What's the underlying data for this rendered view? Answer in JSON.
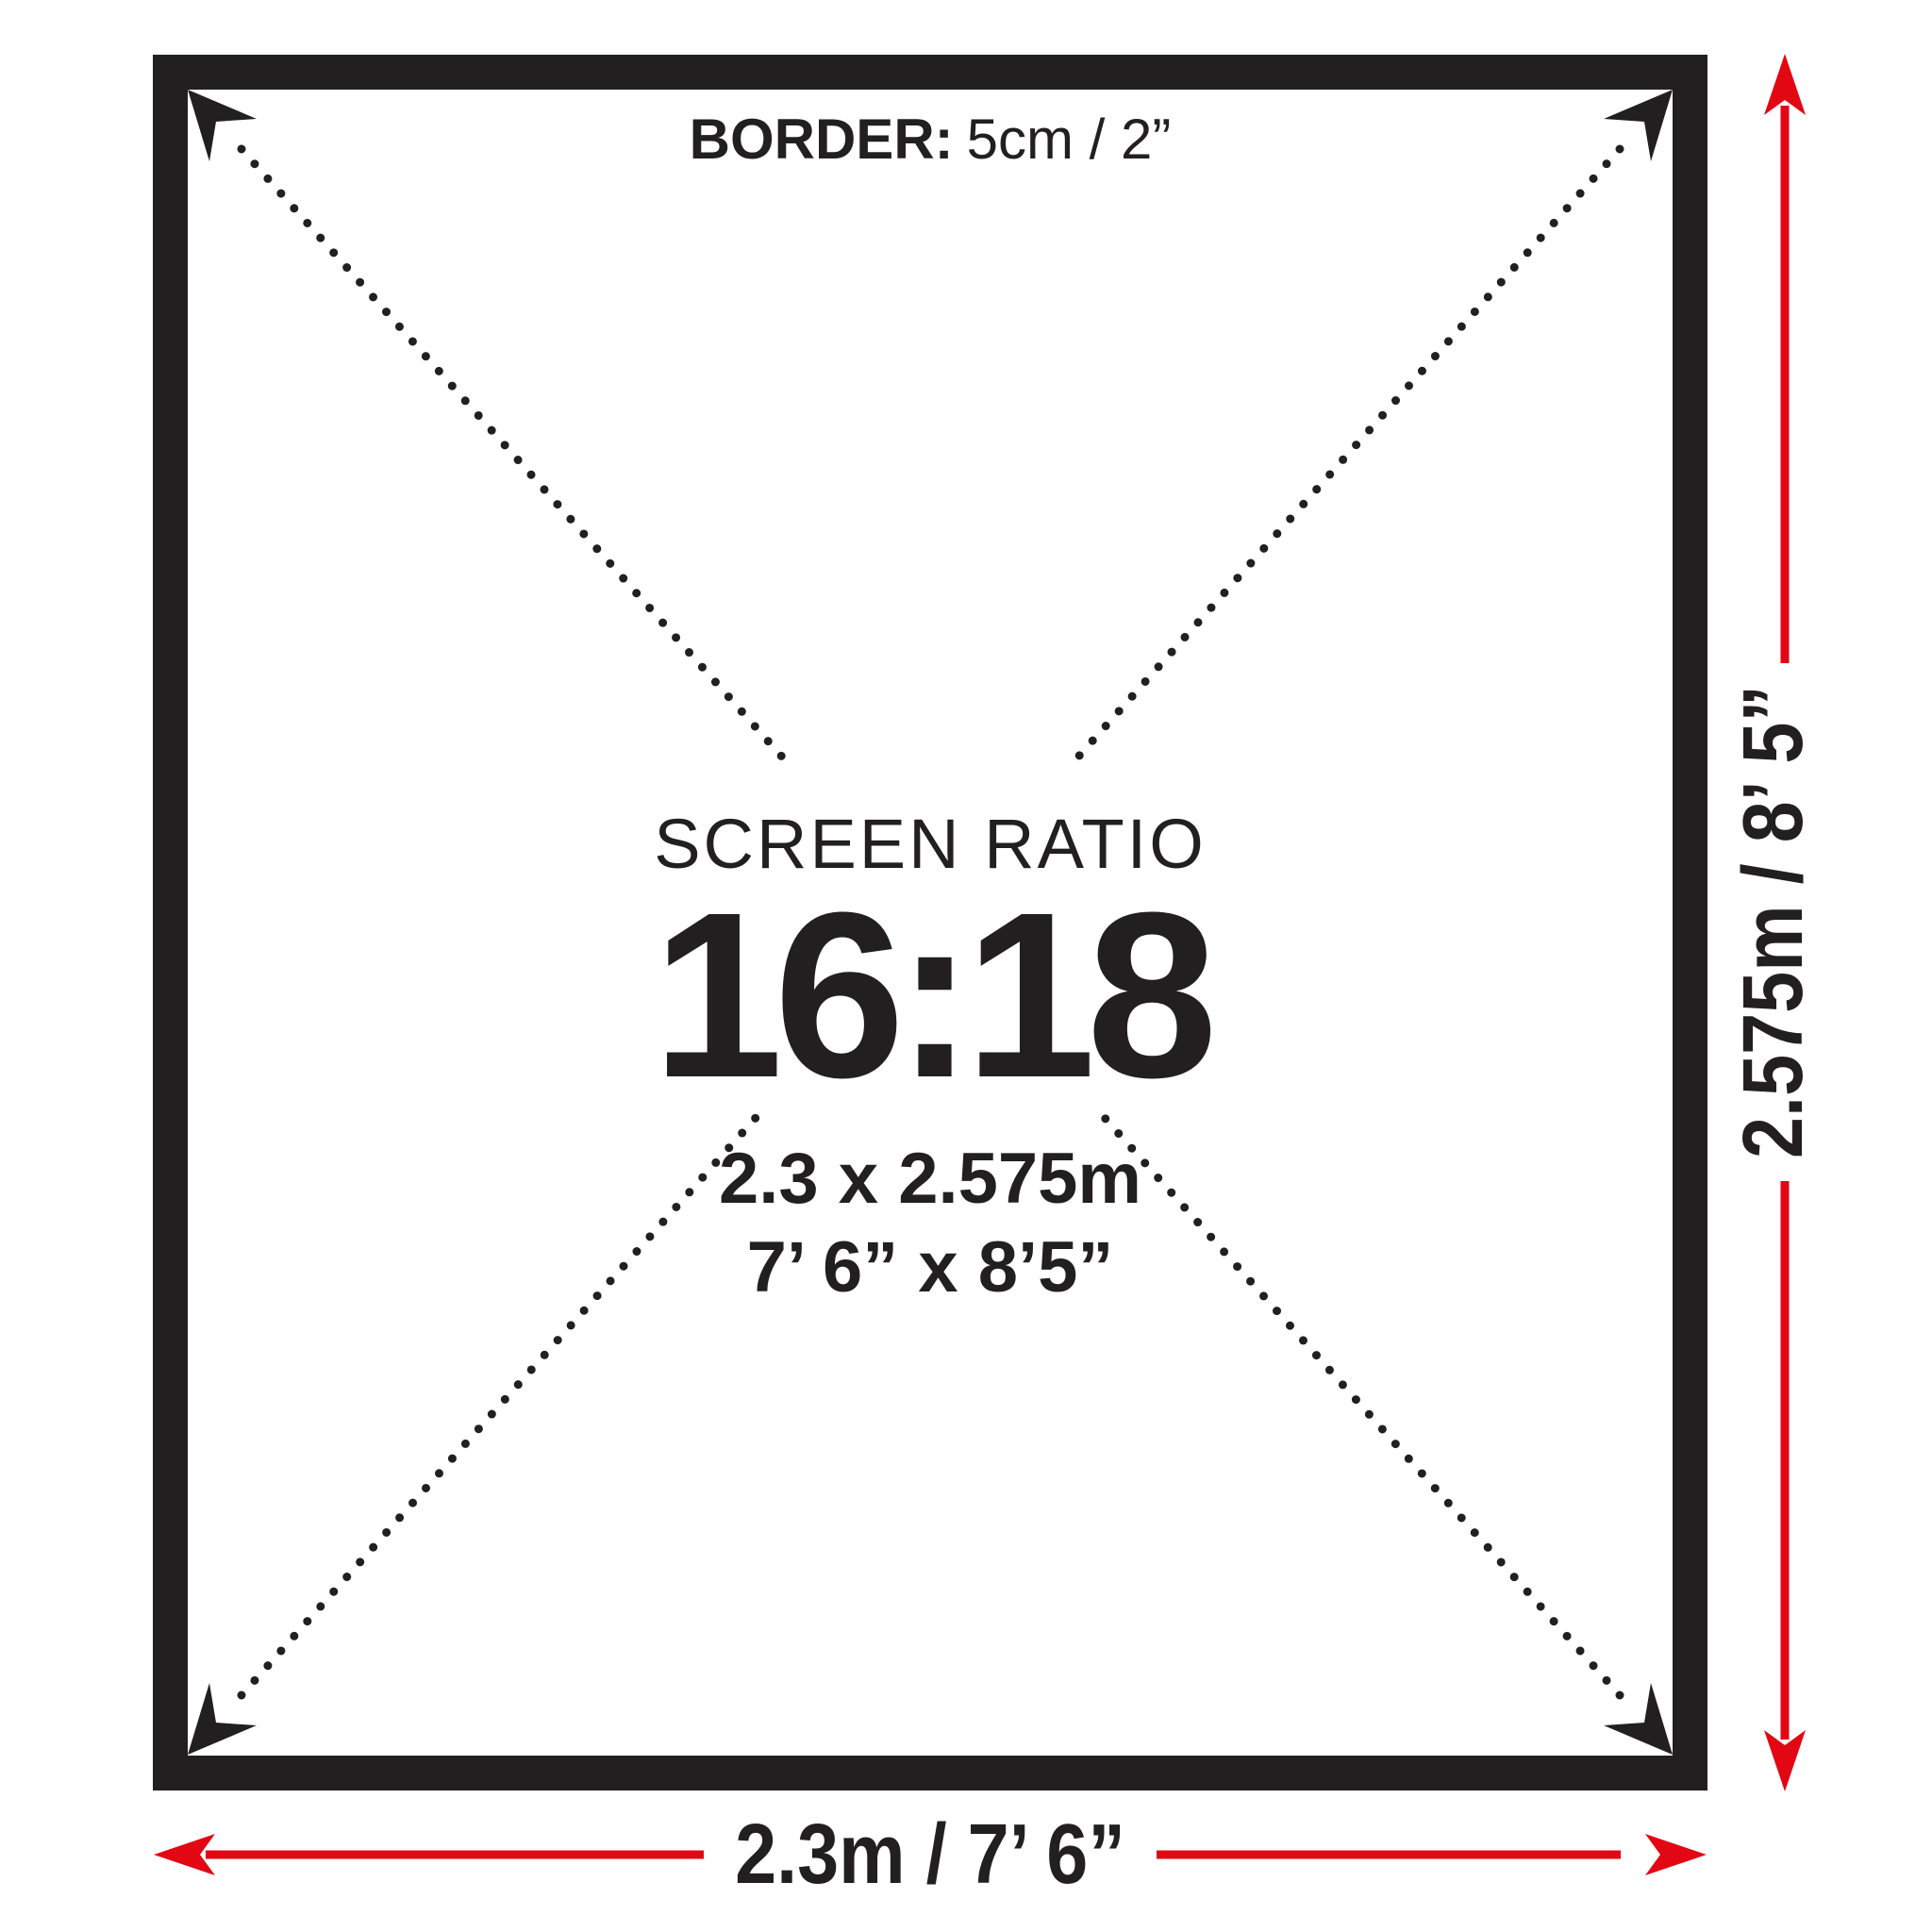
{
  "diagram": {
    "border_note": {
      "label": "BORDER:",
      "value": "5cm / 2”"
    },
    "center": {
      "title": "SCREEN RATIO",
      "ratio": "16:18",
      "size_metric": "2.3 x 2.575m",
      "size_imperial": "7’ 6” x 8’5”"
    },
    "dimensions": {
      "width_label": "2.3m / 7’ 6”",
      "height_label": "2.575m / 8’ 5”"
    },
    "colors": {
      "frame_black": "#221f20",
      "arrow_red": "#e30613"
    }
  }
}
